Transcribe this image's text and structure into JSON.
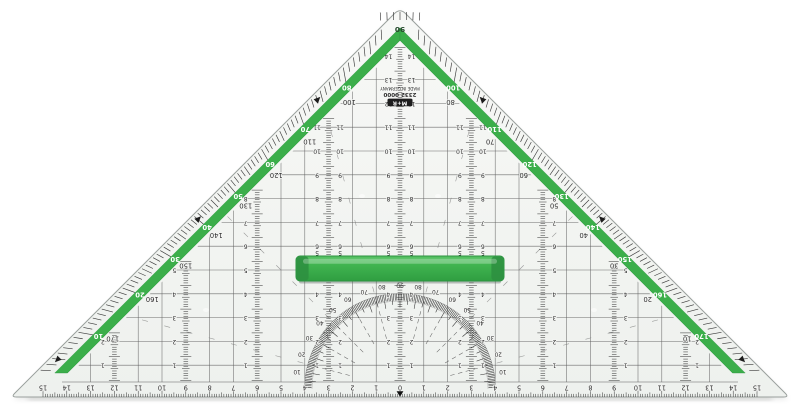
{
  "image": {
    "description": "transparent geometry set square (Geodreieck) with green edge scales and green handle",
    "background": "#ffffff"
  },
  "colors": {
    "green": "#3bae4a",
    "green_dark": "#2c9340",
    "green_light": "#58c264",
    "plastic": "#f4f5f3",
    "plastic_edge": "#9aa09d",
    "print": "#2f2f2f",
    "grid": "#5e5e5e",
    "white_label": "#ffffff"
  },
  "brand": {
    "logo": "M+R",
    "model": "2332 0000",
    "origin": "MADE IN GERMANY"
  },
  "apex_label": "90",
  "edge_scales": {
    "pairs": [
      {
        "deg": 10,
        "inner": "10",
        "band": "170"
      },
      {
        "deg": 20,
        "inner": "20",
        "band": "160"
      },
      {
        "deg": 30,
        "inner": "30",
        "band": "150"
      },
      {
        "deg": 40,
        "inner": "40",
        "band": "140"
      },
      {
        "deg": 50,
        "inner": "50",
        "band": "130"
      },
      {
        "deg": 60,
        "inner": "60",
        "band": "120"
      },
      {
        "deg": 70,
        "inner": "70",
        "band": "110"
      },
      {
        "deg": 80,
        "inner": "80",
        "band": "100"
      },
      {
        "deg": 100,
        "inner": "100",
        "band": "80"
      },
      {
        "deg": 110,
        "inner": "110",
        "band": "70"
      },
      {
        "deg": 120,
        "inner": "120",
        "band": "60"
      },
      {
        "deg": 130,
        "inner": "130",
        "band": "50"
      },
      {
        "deg": 140,
        "inner": "140",
        "band": "40"
      },
      {
        "deg": 150,
        "inner": "150",
        "band": "30"
      },
      {
        "deg": 160,
        "inner": "160",
        "band": "20"
      },
      {
        "deg": 170,
        "inner": "170",
        "band": "10"
      }
    ],
    "arrow_angles": [
      5,
      40,
      74,
      106,
      140,
      175
    ]
  },
  "protractor": {
    "ring_labels": [
      "10",
      "20",
      "30",
      "40",
      "50",
      "60",
      "70",
      "80",
      "90",
      "80",
      "70",
      "60",
      "50",
      "40",
      "30",
      "20",
      "10"
    ]
  },
  "bottom_ruler": {
    "labels": [
      "15",
      "14",
      "13",
      "12",
      "11",
      "10",
      "9",
      "8",
      "7",
      "6",
      "5",
      "4",
      "3",
      "2",
      "1",
      "0",
      "1",
      "2",
      "3",
      "4",
      "5",
      "6",
      "7",
      "8",
      "9",
      "10",
      "11",
      "12",
      "13",
      "14",
      "15"
    ]
  },
  "columns": [
    {
      "offset_cm": 0,
      "numbers": [
        "1",
        "2",
        "3",
        "4",
        "5",
        "6",
        "7",
        "8",
        "9",
        "10",
        "11",
        "12",
        "13",
        "14"
      ],
      "number_side": "both"
    },
    {
      "offset_cm": -3,
      "numbers": [
        "1",
        "2",
        "3",
        "4",
        "5",
        "6",
        "7",
        "8",
        "9",
        "10",
        "11"
      ],
      "number_side": "both"
    },
    {
      "offset_cm": 3,
      "numbers": [
        "1",
        "2",
        "3",
        "4",
        "5",
        "6",
        "7",
        "8",
        "9",
        "10",
        "11"
      ],
      "number_side": "both"
    },
    {
      "offset_cm": -6,
      "numbers": [
        "1",
        "2",
        "3",
        "4",
        "5",
        "6",
        "7",
        "8"
      ],
      "number_side": "left"
    },
    {
      "offset_cm": 6,
      "numbers": [
        "1",
        "2",
        "3",
        "4",
        "5",
        "6",
        "7",
        "8"
      ],
      "number_side": "right"
    },
    {
      "offset_cm": -9,
      "numbers": [
        "1",
        "2",
        "3",
        "4",
        "5"
      ],
      "number_side": "left"
    },
    {
      "offset_cm": 9,
      "numbers": [
        "1",
        "2",
        "3",
        "4",
        "5"
      ],
      "number_side": "right"
    },
    {
      "offset_cm": -12,
      "numbers": [
        "1",
        "2"
      ],
      "number_side": "left"
    },
    {
      "offset_cm": 12,
      "numbers": [
        "1",
        "2"
      ],
      "number_side": "right"
    }
  ]
}
